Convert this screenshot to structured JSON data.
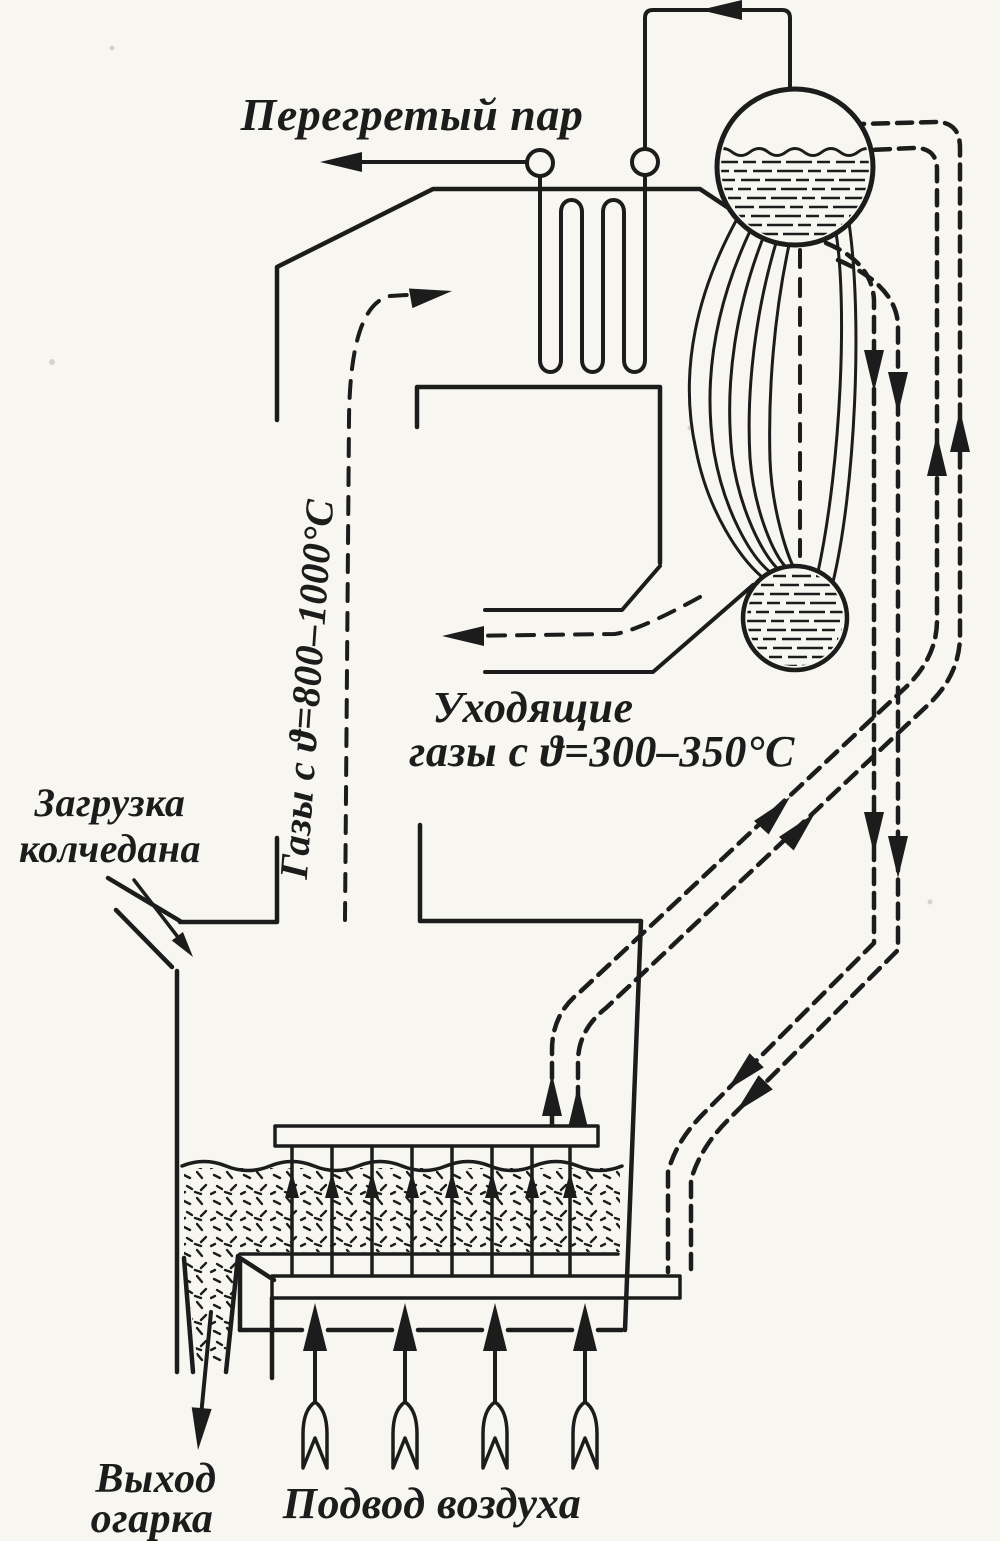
{
  "diagram": {
    "labels": {
      "superheated_steam": "Перегретый пар",
      "hot_gases": "Газы с ϑ=800–1000°C",
      "exit_gases_line1": "Уходящие",
      "exit_gases_line2": "газы с ϑ=300–350°C",
      "pyrite_loading_line1": "Загрузка",
      "pyrite_loading_line2": "колчедана",
      "cinder_outlet_line1": "Выход",
      "cinder_outlet_line2": "огарка",
      "air_supply": "Подвод воздуха"
    },
    "colors": {
      "ink": "#1c1c1c",
      "paper": "#f7f6f1"
    }
  }
}
